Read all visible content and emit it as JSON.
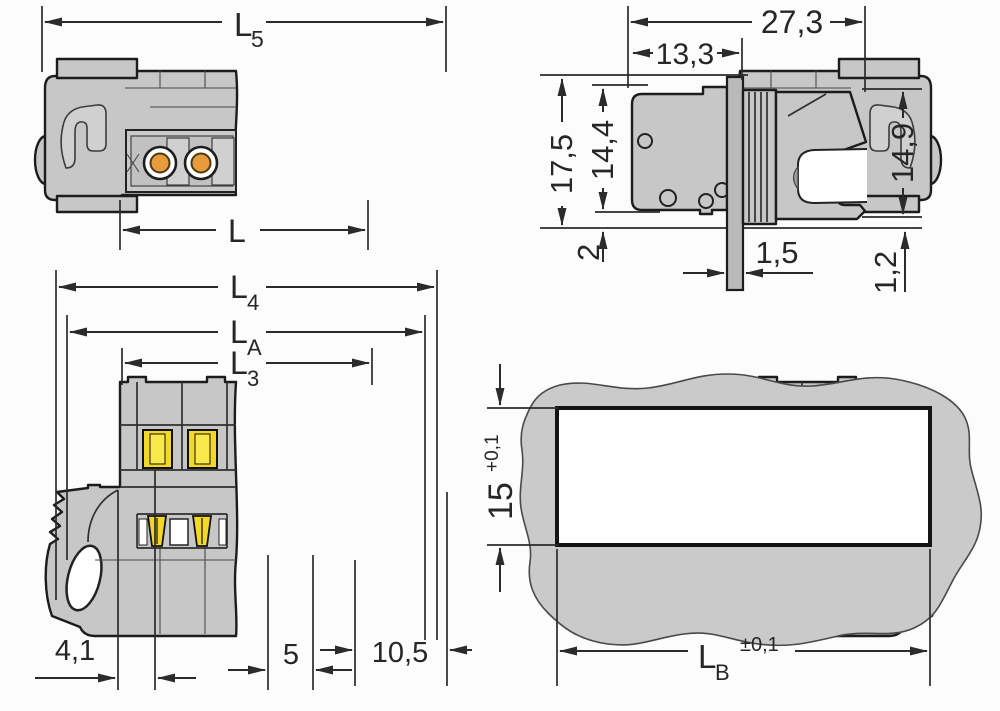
{
  "drawing_type": "connector-dimension-drawing",
  "colors": {
    "background": "#fcfcfc",
    "body_gray": "#c6c7c6",
    "flange_gray": "#b9bab9",
    "panel_gray": "#c9cac9",
    "outline": "#1c1c1c",
    "dim_line": "#2b2b2b",
    "contact_orange": "#e79b3c",
    "lever_yellow": "#f3d829",
    "lever_yellow_light": "#f9e84a",
    "cutout_white": "#ffffff"
  },
  "views": {
    "front": {
      "name": "front-view",
      "dims": {
        "L5": {
          "base": "L",
          "sub": "5"
        },
        "L": {
          "base": "L"
        }
      }
    },
    "side": {
      "name": "side-view",
      "dims": {
        "width_total": "27,3",
        "width_front": "13,3",
        "height_total": "17,5",
        "height_front": "14,4",
        "height_rear": "14,9",
        "pin_length": "2",
        "flange_thickness": "1,5",
        "rear_offset": "1,2"
      }
    },
    "underside": {
      "name": "underside-view",
      "dims": {
        "L4": {
          "base": "L",
          "sub": "4"
        },
        "LA": {
          "base": "L",
          "sub": "A"
        },
        "L3": {
          "base": "L",
          "sub": "3"
        },
        "foot": "4,1",
        "pitch": "5",
        "end": "10,5"
      }
    },
    "cutout": {
      "name": "panel-cutout-view",
      "dims": {
        "height": {
          "value": "15",
          "tol": "+0,1"
        },
        "width": {
          "base": "L",
          "sub": "B",
          "tol": "±0,1"
        }
      }
    }
  }
}
